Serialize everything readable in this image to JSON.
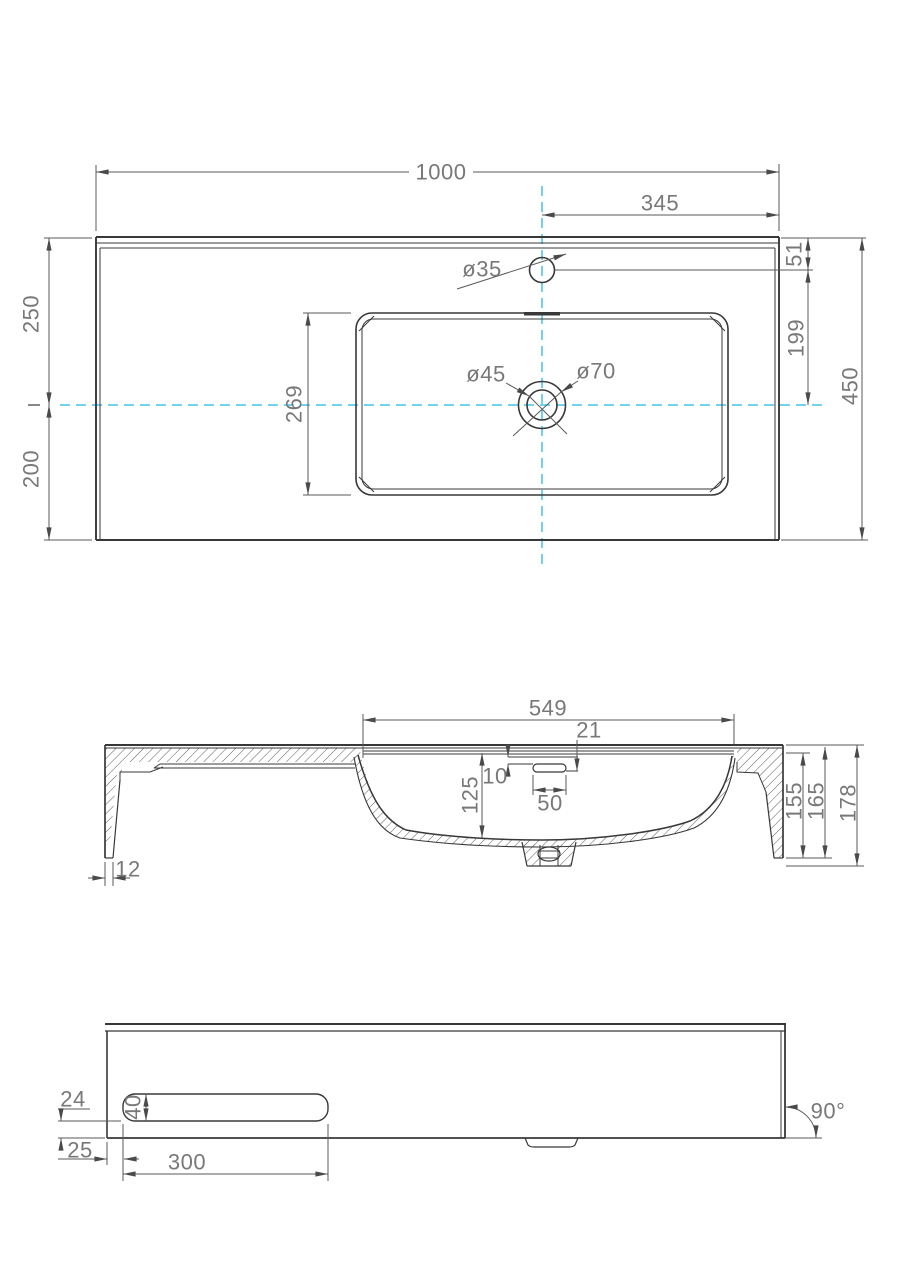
{
  "meta": {
    "background_color": "#ffffff",
    "line_color": "#383838",
    "dim_line_color": "#5a5a5a",
    "text_color": "#787878",
    "centerline_color": "#44c3e6"
  },
  "top_view": {
    "overall_width": "1000",
    "center_to_right_edge": "345",
    "edge_to_faucet_center": "51",
    "faucet_to_centerline": "199",
    "overall_depth": "450",
    "front_half_depth": "250",
    "back_half_depth": "200",
    "basin_inner_depth": "269",
    "faucet_hole_dia": "ø35",
    "drain_inner_dia": "ø45",
    "drain_outer_dia": "ø70"
  },
  "section_view": {
    "basin_top_width": "549",
    "overflow_edge_offset": "21",
    "rim_recess_depth": "10",
    "overflow_slot_width": "50",
    "bowl_depth": "125",
    "side_inner_height": "155",
    "side_height": "165",
    "overall_height": "178",
    "bottom_wall_thickness": "12"
  },
  "front_view": {
    "slot_to_bottom_edge": "24",
    "slot_height": "40",
    "edge_to_slot": "25",
    "slot_width": "300",
    "corner_angle": "90°"
  }
}
